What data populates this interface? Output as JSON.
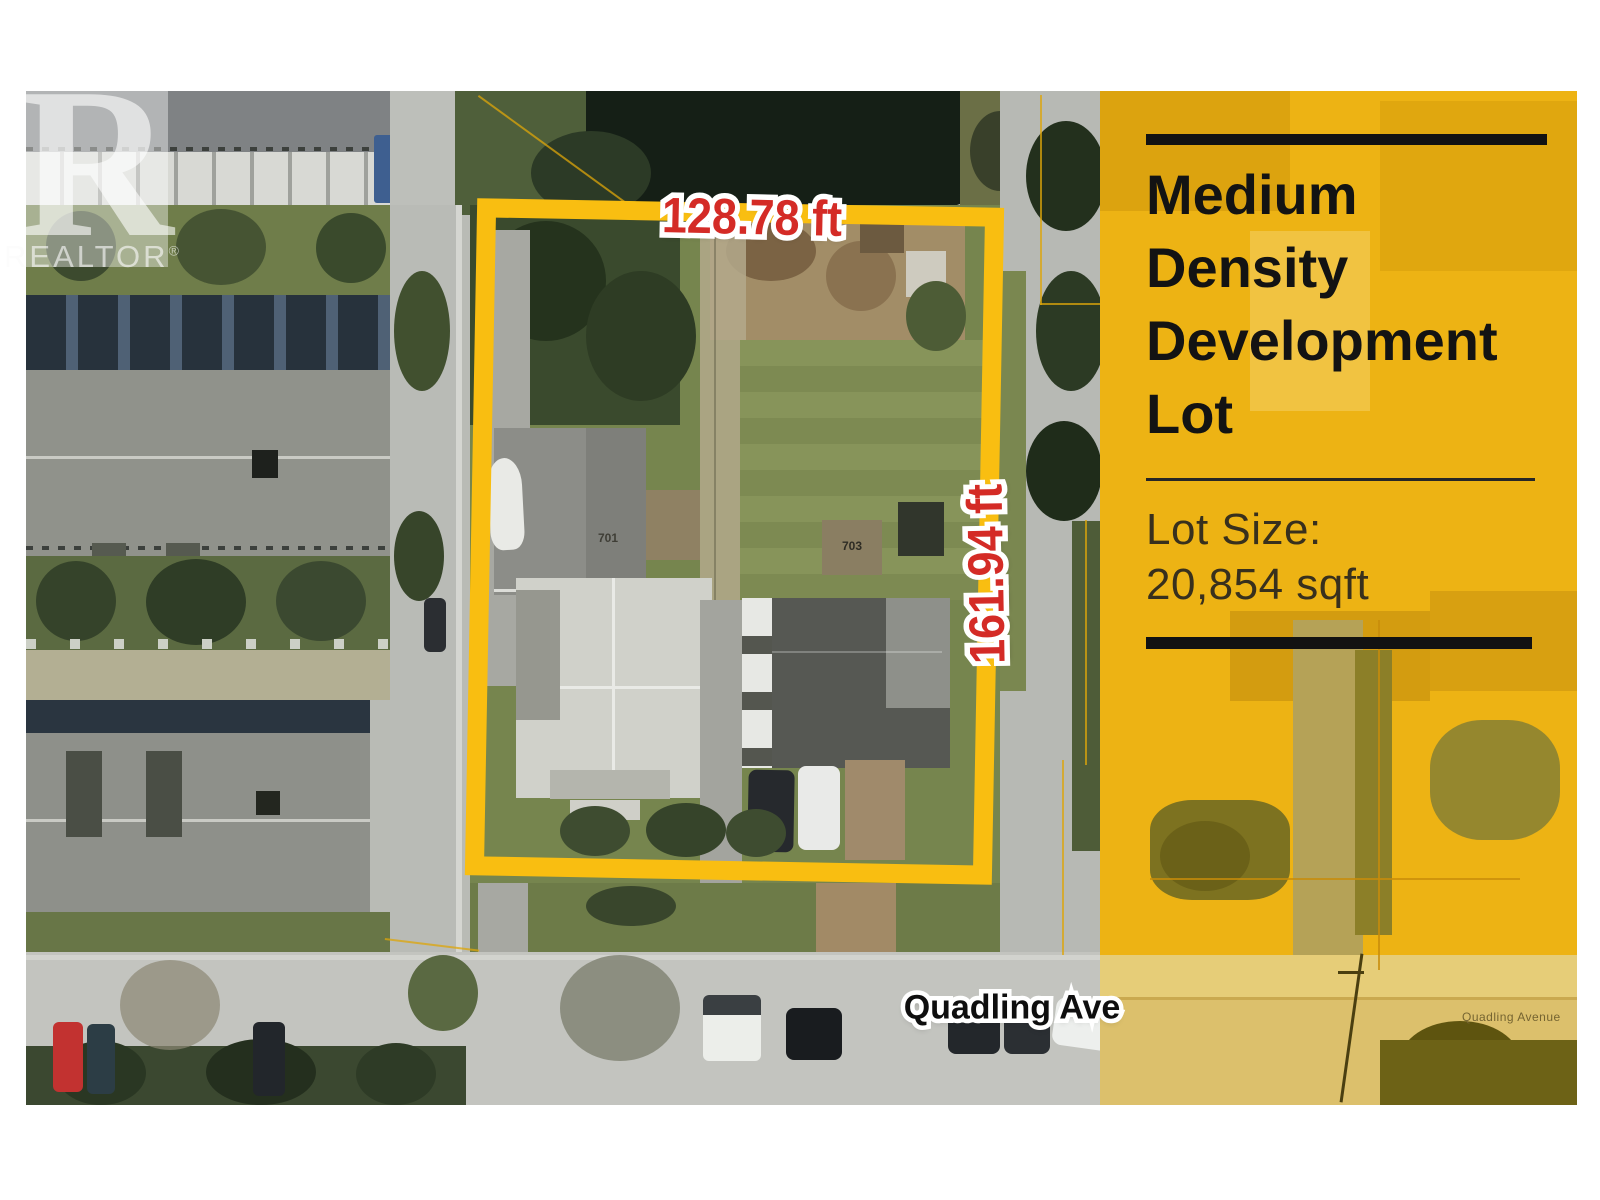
{
  "watermark": {
    "letter": "R",
    "brand": "REALTOR",
    "reg": "®"
  },
  "dimensions": {
    "top": "128.78 ft",
    "right": "161.94 ft"
  },
  "street": {
    "label": "Quadling Ave",
    "map_label": "Quadling Avenue"
  },
  "houses": {
    "left_number": "701",
    "right_number": "703"
  },
  "panel": {
    "title_lines": [
      "Medium",
      "Density",
      "Development",
      "Lot"
    ],
    "lot_size_label": "Lot Size:",
    "lot_size_value": "20,854 sqft"
  },
  "colors": {
    "lot_outline": "#f9be11",
    "panel_yellow": "#edb314",
    "dimension_red": "#d42b26",
    "photo_road_gray": "#b9bbb5"
  }
}
